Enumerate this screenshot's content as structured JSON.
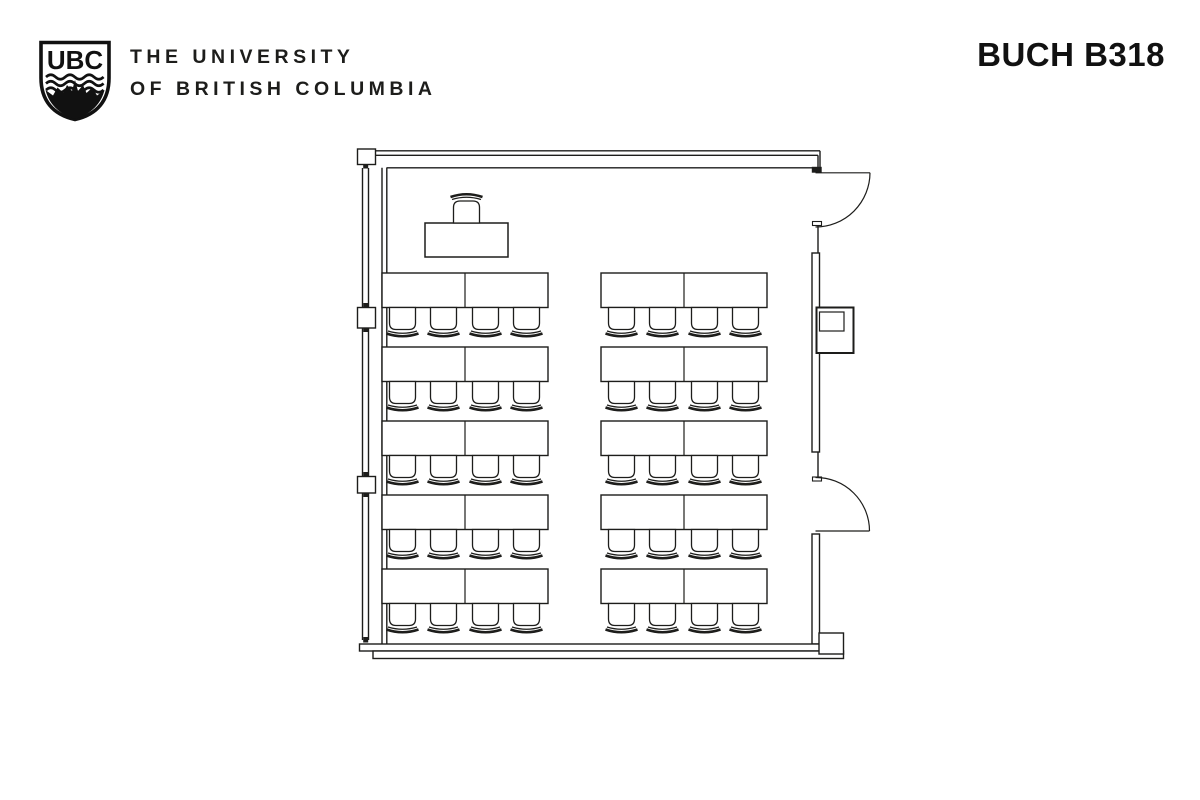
{
  "header": {
    "logo_text": "UBC",
    "university_line1": "THE UNIVERSITY",
    "university_line2": "OF BRITISH COLUMBIA",
    "room_title": "BUCH B318"
  },
  "floor_plan": {
    "room_label": "BUCH B318",
    "layout": {
      "seat_rows": 5,
      "blocks_per_row": 2,
      "tables_per_block": 2,
      "chairs_per_table": 2,
      "student_seat_count": 40,
      "table_count": 20
    },
    "fixtures": {
      "instructor_desk_count": 1,
      "instructor_chair_count": 1,
      "door_count": 2,
      "window_wall_side": "left",
      "doors_side": "right"
    },
    "colors": {
      "line": "#1d1d1b",
      "background": "#ffffff"
    }
  }
}
